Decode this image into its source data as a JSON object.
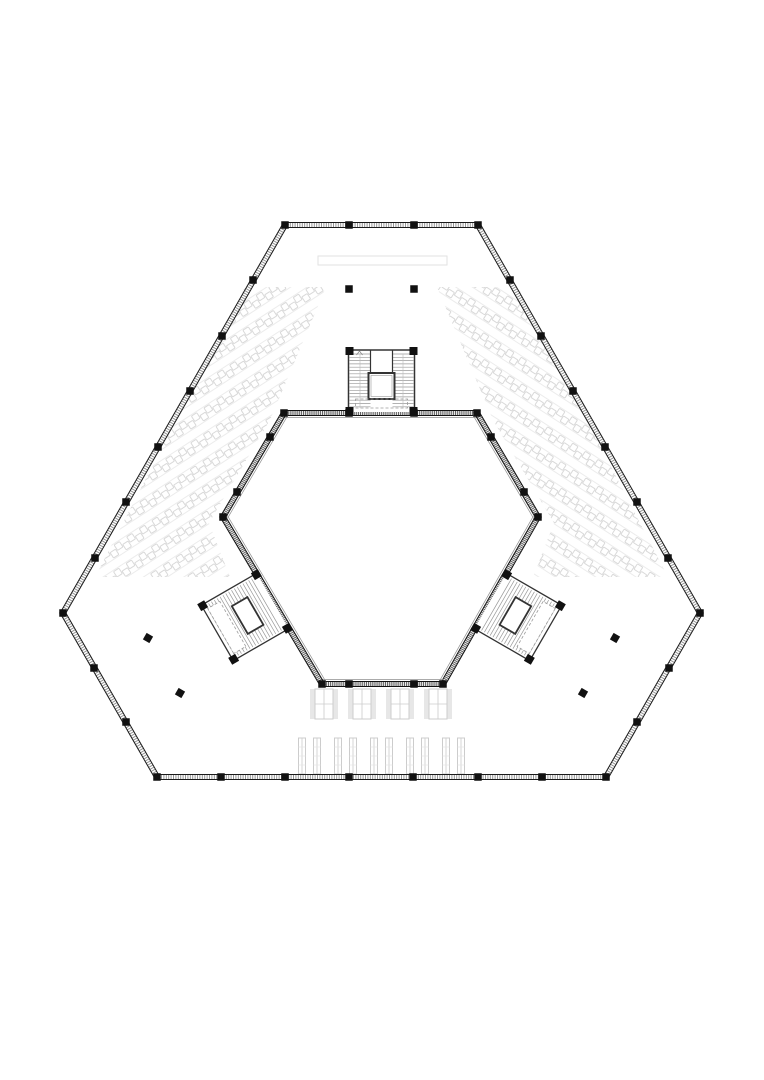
{
  "meta": {
    "title": "hexagonal-building-floor-plan",
    "drawing_type": "architectural plan"
  },
  "canvas": {
    "width": 764,
    "height": 1080,
    "background": "#ffffff"
  },
  "colors": {
    "wall_edge": "#1a1a1a",
    "inner_wall_edge": "#111111",
    "hatch_outer": "#8a8a8a",
    "hatch_inner": "#555555",
    "column_fill": "#111111",
    "stair_tread": "#999999",
    "stair_wall": "#333333",
    "dashed_line": "#9a9a9a",
    "rail": "#bbbbbb",
    "table_stroke": "#ececec",
    "chair_stroke": "#d9d9d9",
    "table_group_stroke": "#cccccc",
    "strip_fill": "#e7e7e7",
    "band_stroke": "#e2e2e2"
  },
  "outer_wall": {
    "thickness": 5,
    "vertices": [
      [
        285,
        225
      ],
      [
        478,
        225
      ],
      [
        700,
        613
      ],
      [
        606,
        777
      ],
      [
        157,
        777
      ],
      [
        63,
        613
      ]
    ]
  },
  "inner_wall": {
    "thickness": 5,
    "offset_line": 4.5,
    "centroid": [
      381.5,
      545
    ],
    "vertices": [
      [
        284,
        413
      ],
      [
        477,
        413
      ],
      [
        538,
        517
      ],
      [
        443,
        684
      ],
      [
        322,
        684
      ],
      [
        223,
        517
      ]
    ]
  },
  "columns": {
    "size": 7.5,
    "wall": [
      [
        285,
        225
      ],
      [
        349,
        225
      ],
      [
        414,
        225
      ],
      [
        478,
        225
      ],
      [
        253,
        280
      ],
      [
        222,
        336
      ],
      [
        190,
        391
      ],
      [
        158,
        447
      ],
      [
        126,
        502
      ],
      [
        95,
        558
      ],
      [
        63,
        613
      ],
      [
        510,
        280
      ],
      [
        541,
        336
      ],
      [
        573,
        391
      ],
      [
        605,
        447
      ],
      [
        637,
        502
      ],
      [
        668,
        558
      ],
      [
        700,
        613
      ],
      [
        94,
        668
      ],
      [
        126,
        722
      ],
      [
        157,
        777
      ],
      [
        669,
        668
      ],
      [
        637,
        722
      ],
      [
        606,
        777
      ],
      [
        221,
        777
      ],
      [
        285,
        777
      ],
      [
        349,
        777
      ],
      [
        413,
        777
      ],
      [
        478,
        777
      ],
      [
        542,
        777
      ],
      [
        284,
        413
      ],
      [
        477,
        413
      ],
      [
        538,
        517
      ],
      [
        443,
        684
      ],
      [
        322,
        684
      ],
      [
        223,
        517
      ],
      [
        349,
        413
      ],
      [
        414,
        413
      ],
      [
        349,
        684
      ],
      [
        414,
        684
      ],
      [
        270,
        437
      ],
      [
        237,
        492
      ],
      [
        491,
        437
      ],
      [
        524,
        492
      ]
    ],
    "free_square": [
      [
        349,
        289
      ],
      [
        414,
        289
      ]
    ],
    "free_diamond": [
      [
        148,
        638
      ],
      [
        615,
        638
      ],
      [
        180,
        693
      ],
      [
        583,
        693
      ]
    ]
  },
  "stair_cores": {
    "top": {
      "cx": 381.5,
      "cy": 381,
      "rotation": 0,
      "kind": "elevator"
    },
    "left": {
      "cx": 245,
      "cy": 617,
      "rotation": -120,
      "kind": "switchback"
    },
    "right": {
      "cx": 518,
      "cy": 617,
      "rotation": 120,
      "kind": "switchback"
    }
  },
  "desk_fields": {
    "row_angle_deg": 33,
    "row_pitch": 22,
    "chair_pitch": 15,
    "chair_size": 6.4,
    "table_depth": 9,
    "left": {
      "angle": -33,
      "center": [
        200,
        430
      ],
      "clip": [
        [
          245,
          287
        ],
        [
          326,
          287
        ],
        [
          270,
          420
        ],
        [
          209,
          523
        ],
        [
          230,
          577
        ],
        [
          95,
          577
        ]
      ]
    },
    "right": {
      "angle": 33,
      "center": [
        563,
        430
      ],
      "clip": [
        [
          518,
          287
        ],
        [
          437,
          287
        ],
        [
          493,
          420
        ],
        [
          554,
          523
        ],
        [
          533,
          577
        ],
        [
          668,
          577
        ]
      ]
    }
  },
  "tables_row_a": {
    "top": 689,
    "height": 30,
    "centers": [
      324,
      362,
      400,
      438
    ]
  },
  "tables_row_b": {
    "top": 738,
    "height": 36,
    "centers": [
      309.5,
      345.5,
      381.5,
      417.5,
      453.5
    ]
  },
  "reception_band": {
    "x": 318,
    "y": 256,
    "w": 129,
    "h": 9
  }
}
